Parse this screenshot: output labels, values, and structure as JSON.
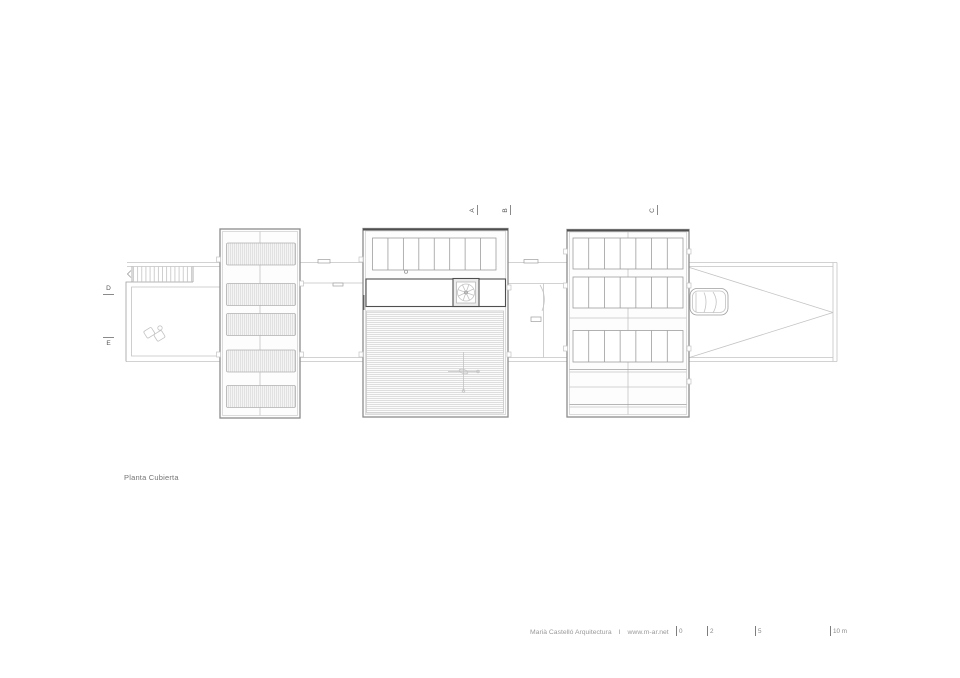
{
  "drawing": {
    "label": "Planta Cubierta"
  },
  "sections": {
    "a": "A",
    "b": "B",
    "c": "C",
    "d": "D",
    "e": "E"
  },
  "footer": {
    "firm": "Marià Castelló Arquitectura",
    "separator": "I",
    "website": "www.m-ar.net",
    "scale": {
      "ticks": [
        "0",
        "2",
        "5",
        "10 m"
      ]
    }
  },
  "plan": {
    "left_block": {
      "panel_count": 5
    },
    "middle_block": {
      "top_cells": 8,
      "skylight_fan_spokes": 8
    },
    "right_block": {
      "rows": 3,
      "cells_per_row": 7
    },
    "stair": {
      "treads": 15
    },
    "colors": {
      "line_light": "#c3c3c3",
      "line_mid": "#9e9e9e",
      "line_dark": "#565656",
      "panel_fill": "#f4f4f4",
      "panel_hatch_line": "#d9d9d9",
      "deck_line": "#d1d1d1",
      "text_gray": "#8a8a8a"
    }
  }
}
